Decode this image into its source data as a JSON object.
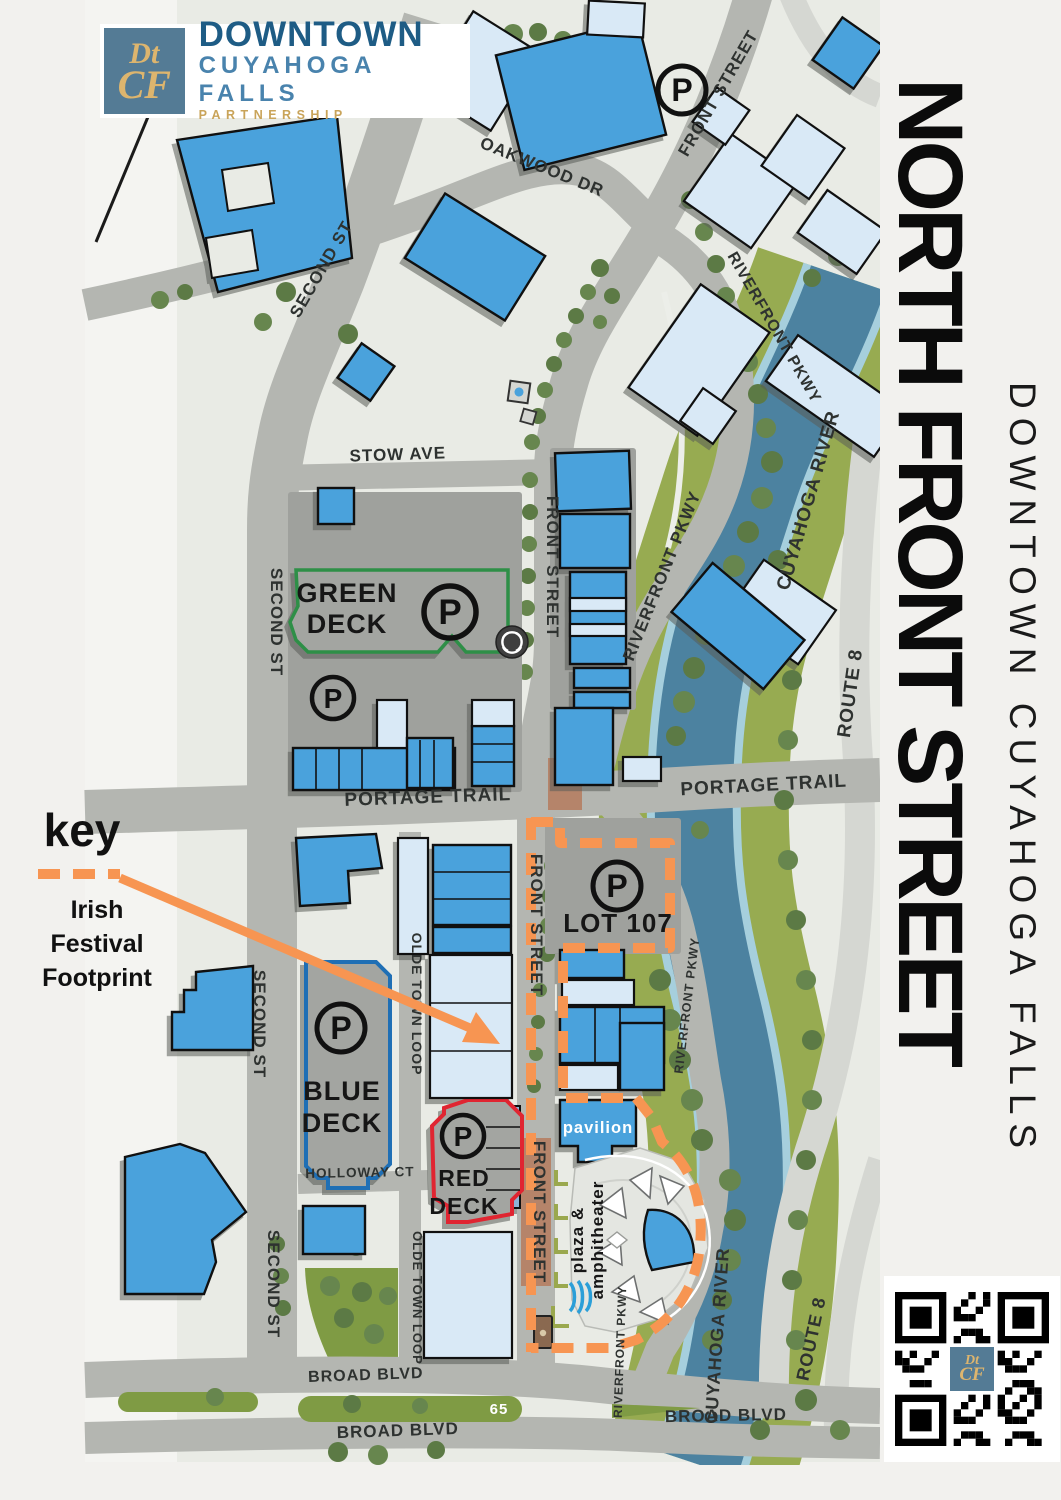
{
  "logo": {
    "mark_line1": "Dt",
    "mark_line2": "CF",
    "title": "DOWNTOWN",
    "subtitle": "CUYAHOGA FALLS",
    "tagline": "PARTNERSHIP"
  },
  "sidebar": {
    "title": "NORTH FRONT STREET",
    "subtitle": "DOWNTOWN CUYAHOGA FALLS"
  },
  "key": {
    "title": "key",
    "line1": "Irish",
    "line2": "Festival",
    "line3": "Footprint"
  },
  "streets": {
    "oakwood": "OAKWOOD DR",
    "front": "FRONT STREET",
    "second": "SECOND ST",
    "stow": "STOW AVE",
    "riverfront": "RIVERFRONT PKWY",
    "portage": "PORTAGE TRAIL",
    "holloway": "HOLLOWAY CT",
    "olde": "OLDE TOWN LOOP",
    "broad": "BROAD BLVD",
    "route8": "ROUTE 8",
    "route65": "65"
  },
  "water": {
    "river": "CUYAHOGA RIVER"
  },
  "parking": {
    "p": "P",
    "lot107": "LOT 107",
    "green_deck_line1": "GREEN",
    "green_deck_line2": "DECK",
    "blue_deck_line1": "BLUE",
    "blue_deck_line2": "DECK",
    "red_deck_line1": "RED",
    "red_deck_line2": "DECK"
  },
  "places": {
    "pavilion": "pavilion",
    "plaza_line1": "plaza &",
    "plaza_line2": "amphitheater"
  },
  "colors": {
    "footprint_orange": "#F79552",
    "building_blue": "#4AA2DC",
    "building_light_blue": "#D9E9F6",
    "river_blue": "#4C82A0",
    "deck_green_outline": "#2E8F47",
    "deck_blue_outline": "#1F6FB5",
    "deck_red_outline": "#E02531"
  }
}
